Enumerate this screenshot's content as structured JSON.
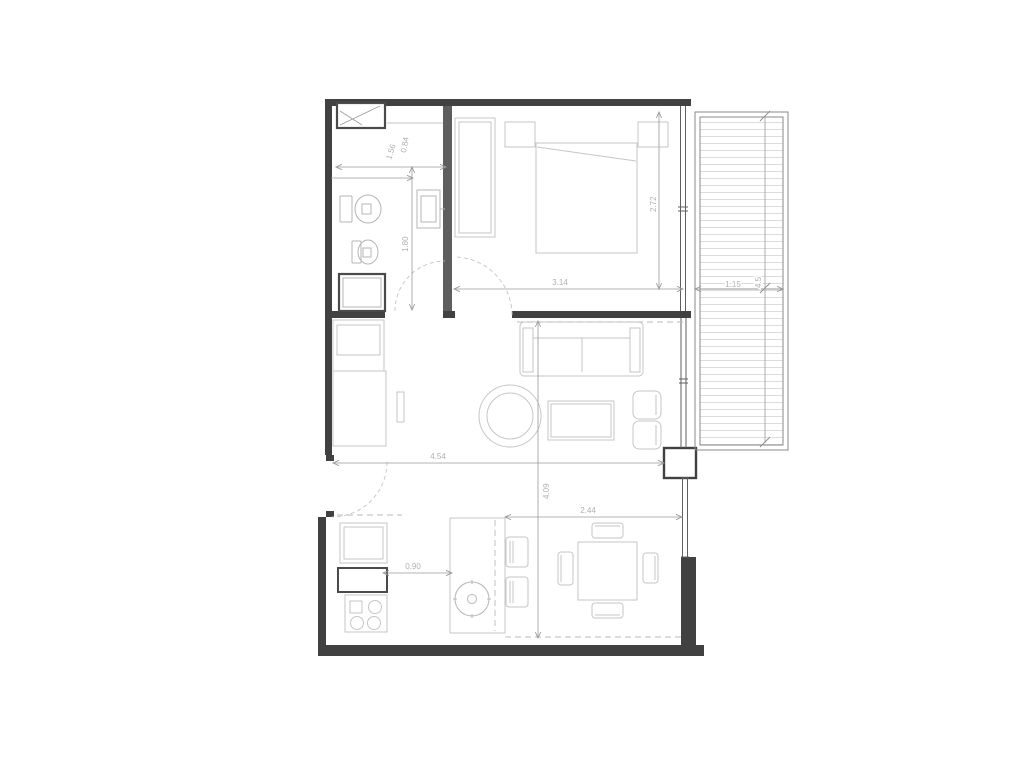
{
  "dimensions": {
    "bathroom_width": "1.56",
    "bathroom_width_2": "0.84",
    "bathroom_depth": "1.80",
    "bedroom_width": "3.14",
    "bedroom_depth": "2.72",
    "living_width": "4.54",
    "living_depth": "4.09",
    "dining_width": "2.44",
    "kitchen_island_gap": "0.90",
    "balcony_width": "1.15",
    "balcony_length": "4.5"
  },
  "colors": {
    "wall": "#414141",
    "fixture_bold": "#4a4a4a",
    "furniture": "#c6c6c6",
    "dimension": "#9a9a9a",
    "label": "#b0b0b0",
    "deck_hatch": "#dcdcdc",
    "background": "#ffffff"
  }
}
